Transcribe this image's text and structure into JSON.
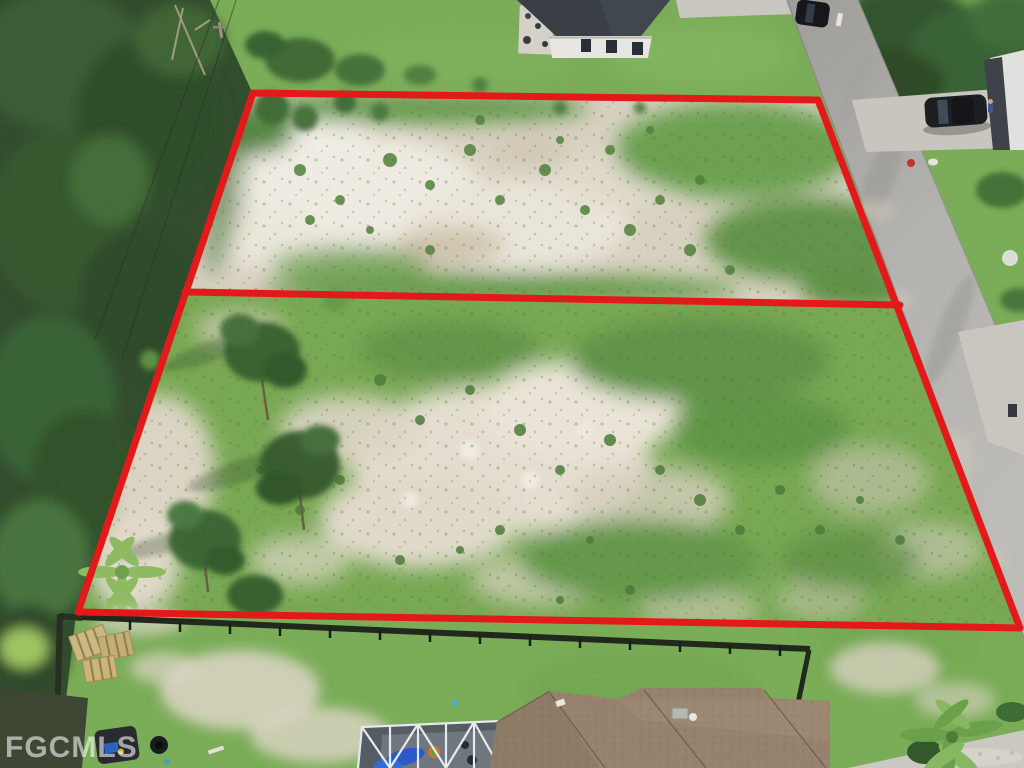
{
  "watermark": {
    "text": "FGCMLS"
  },
  "scene": {
    "type": "aerial-real-estate-photo",
    "description": "Drone aerial view of two adjacent vacant sandy/grassy lots outlined in red, dense trees on the left, a diagonal street with driveways and parked cars on the right, a white house with dark roof at top, and houses with a screened pool enclosure and brown shingle roof at the bottom."
  },
  "colors": {
    "boundary_red": "#e51414",
    "lawn_green": "#79ad55",
    "dark_tree_green": "#2e4a29",
    "sand": "#d9d2c1",
    "road_gray": "#aaa9a5",
    "concrete": "#c8c6bf",
    "roof_dark": "#363b42",
    "roof_brown": "#95806b",
    "fence_dark": "#1c2317",
    "watermark_color": "rgba(255,255,255,0.58)"
  }
}
